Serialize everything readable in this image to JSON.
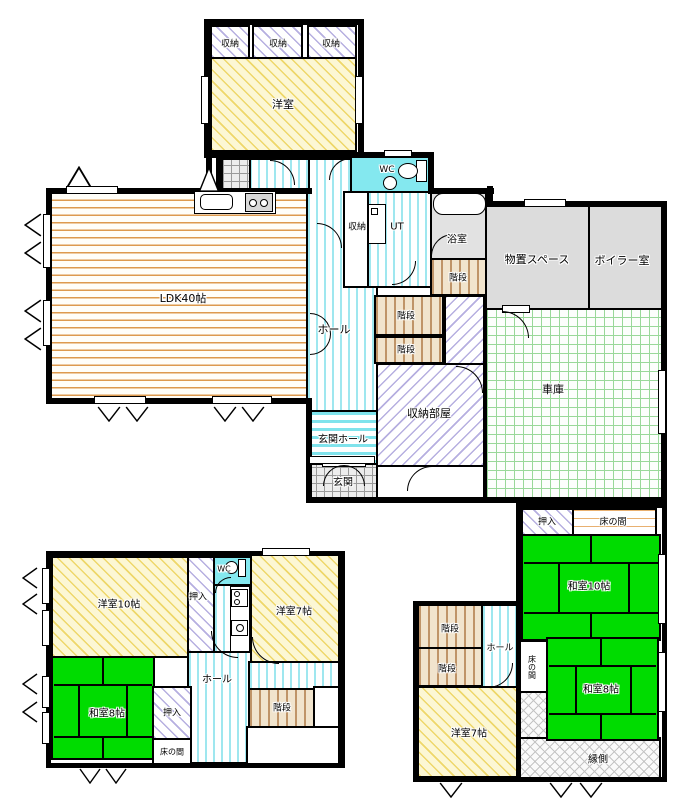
{
  "colors": {
    "wall": "#000000",
    "tatami_green": "#00dc00",
    "wc_cyan": "#84e8ef",
    "room_gray": "#dcdcdc",
    "yellow_hatch": "#eed76a",
    "lavender_hatch": "#b6afe0",
    "cyan_stripe": "#9fe7ef",
    "wood_orange": "#dd9a4e",
    "garage_grid_green": "#9ad89a",
    "stair_tan": "#bf9468",
    "engawa_gray": "#c4c4c4"
  },
  "icons": [
    "toilet-icon",
    "washbasin-icon",
    "bathtub-icon",
    "washing-machine-icon",
    "kitchen-sink-icon",
    "stove-icon",
    "door-swing-arc",
    "window-symbol",
    "vent-triangle-symbol"
  ],
  "upper_floor": {
    "closet1": "収納",
    "closet2": "収納",
    "closet3": "収納",
    "western_room": "洋室"
  },
  "main_floor": {
    "wc": "WC",
    "closet": "収納",
    "ut": "UT",
    "bathroom": "浴室",
    "storage_space": "物置スペース",
    "boiler_room": "ボイラー室",
    "ldk": "LDK40帖",
    "hall": "ホール",
    "stairs_a": "階段",
    "stairs_b": "階段",
    "stairs_c": "階段",
    "garage": "車庫",
    "storage_room": "収納部屋",
    "entrance_hall": "玄関ホール",
    "entrance": "玄関"
  },
  "annex_left": {
    "western10": "洋室10帖",
    "closet_tall": "押入",
    "wc": "WC",
    "western7": "洋室7帖",
    "hall": "ホール",
    "japanese8": "和室8帖",
    "closet": "押入",
    "tokonoma": "床の間",
    "stairs": "階段"
  },
  "annex_right": {
    "closet": "押入",
    "tokonoma_top": "床の間",
    "japanese10": "和室10帖",
    "stairs_upper": "階段",
    "stairs_lower": "階段",
    "hall": "ホール",
    "tokonoma_side": "床の間",
    "japanese8": "和室8帖",
    "western7": "洋室7帖",
    "veranda": "縁側"
  }
}
